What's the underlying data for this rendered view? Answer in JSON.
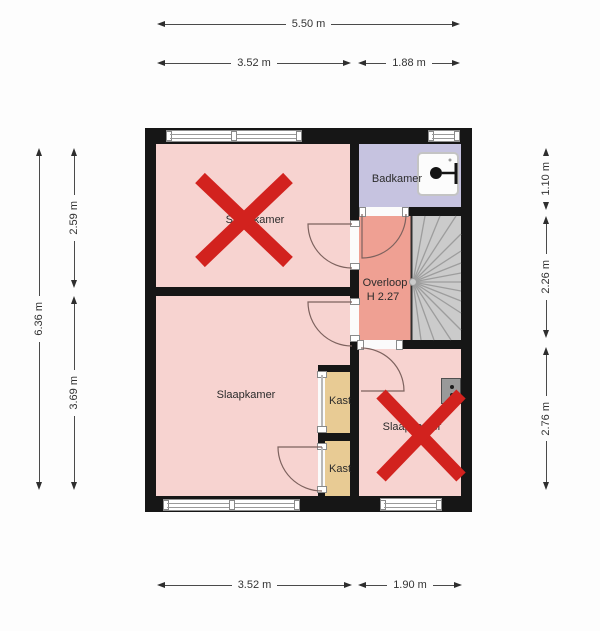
{
  "plan": {
    "type": "floorplan",
    "rooms": {
      "bedroom_top_left": {
        "label": "Slaapkamer",
        "crossed_out": true
      },
      "bathroom": {
        "label": "Badkamer"
      },
      "landing": {
        "label": "Overloop",
        "height": "H 2.27"
      },
      "bedroom_bottom_left": {
        "label": "Slaapkamer"
      },
      "closet_upper": {
        "label": "Kast"
      },
      "closet_lower": {
        "label": "Kast"
      },
      "bedroom_bottom_right": {
        "label": "Slaapkamer",
        "crossed_out": true
      }
    },
    "dimensions": {
      "top_total": "5.50 m",
      "top_left": "3.52 m",
      "top_right": "1.88 m",
      "bottom_left": "3.52 m",
      "bottom_right": "1.90 m",
      "left_total": "6.36 m",
      "left_upper": "2.59 m",
      "left_lower": "3.69 m",
      "right_upper": "1.10 m",
      "right_middle": "2.26 m",
      "right_lower": "2.76 m"
    },
    "colors": {
      "wall": "#161616",
      "bedroom_fill": "#f7d3d0",
      "bathroom_fill": "#c6c3e0",
      "landing_fill": "#efa093",
      "closet_fill": "#e8cb94",
      "stairs_fill": "#cbcbcb",
      "cross_mark": "#d2221e"
    }
  }
}
